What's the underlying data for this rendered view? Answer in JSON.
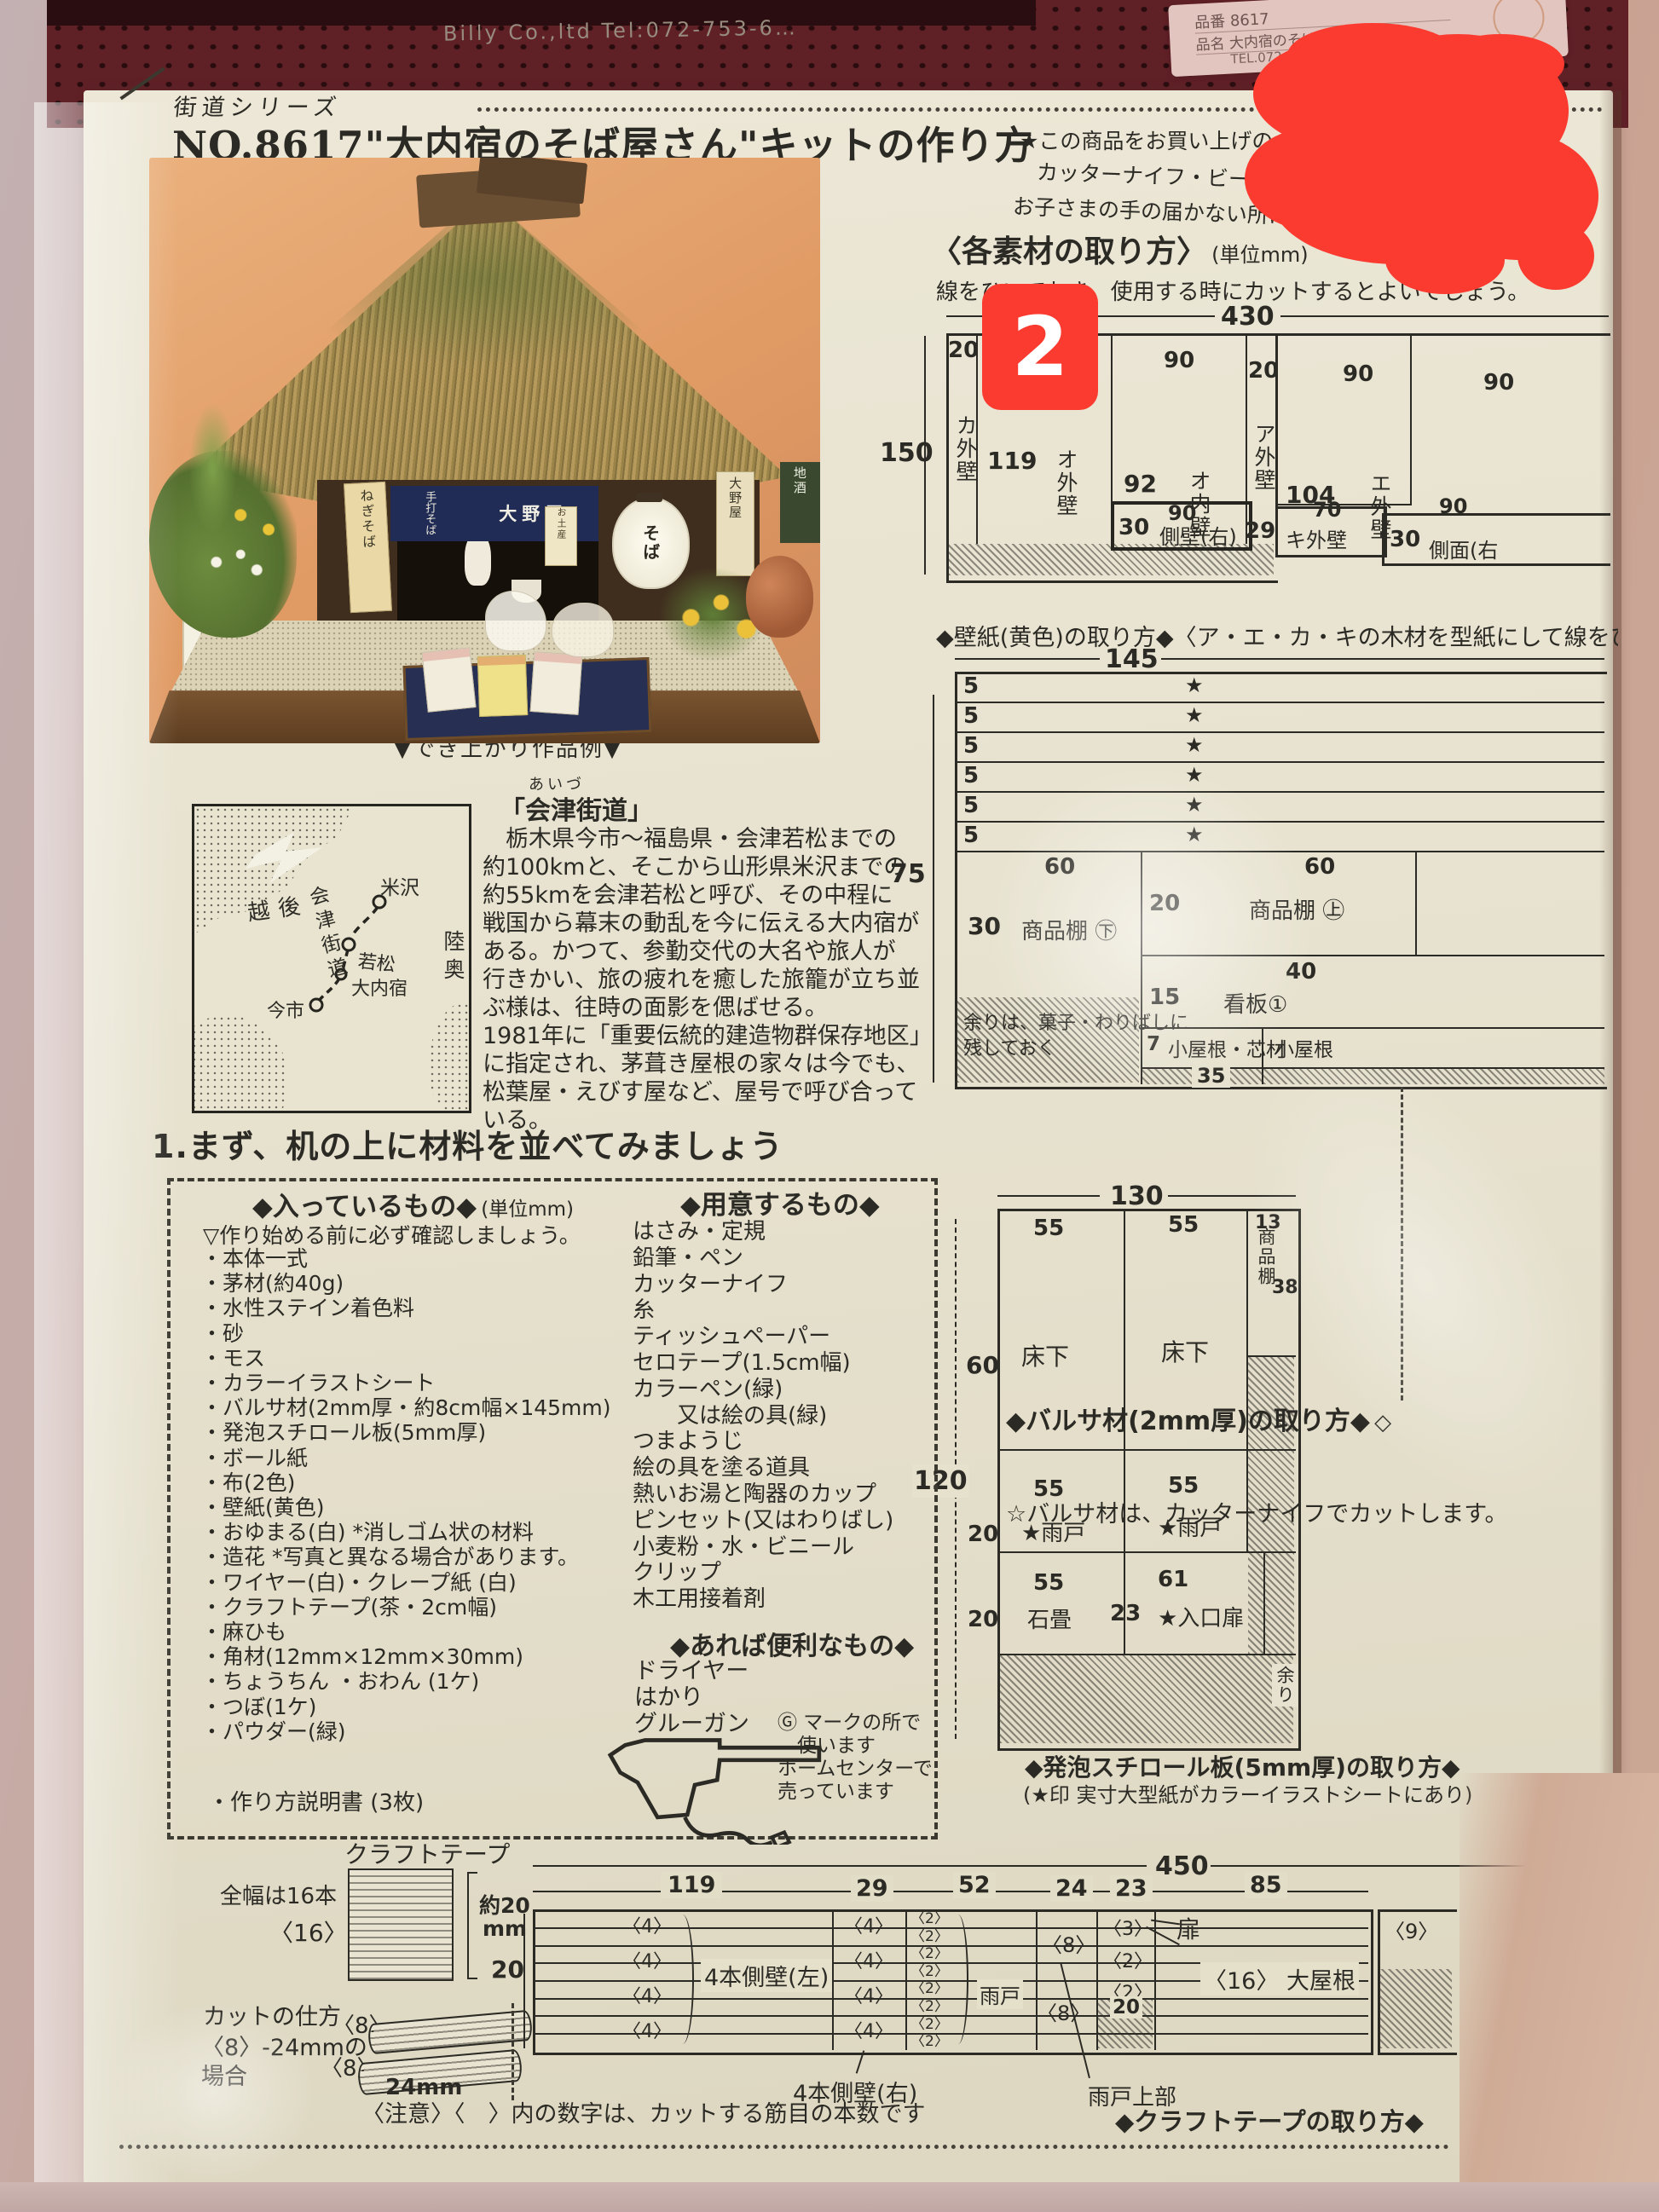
{
  "annotation": {
    "badge": "2"
  },
  "bag": {
    "brand": "Billy Co.,ltd  Tel:072-753-6…",
    "label_product_no": "品番 8617",
    "label_product_name": "品名 大内宿のそば屋さん",
    "label_tel": "TEL.072-755-5420"
  },
  "header": {
    "series": "街道シリーズ",
    "title": "NO.8617\"大内宿のそば屋さん\"キットの作り方"
  },
  "warnings": {
    "line1": "★この商品をお買い上げの",
    "line2": "カッターナイフ・ビーズ・ボ",
    "line3": "お子さまの手の届かない所に保管して"
  },
  "materials_section": {
    "title": "〈各素材の取り方〉",
    "unit": "(単位mm)",
    "note": "線をひいておき、使用する時にカットするとよいでしょう。"
  },
  "wallpaper_diagram": {
    "caption": "◆壁紙(黄色)の取り方◆〈ア・エ・カ・キの木材を型紙にして線をひき、",
    "dim_total_w": "430",
    "dim_total_h": "150",
    "col_dims": [
      "20",
      "90",
      "90",
      "20",
      "90",
      "90"
    ],
    "cells": {
      "ka": "カ外壁",
      "o_out_h": "119",
      "o_out": "オ外壁",
      "o_in_h": "92",
      "o_in": "オ内壁",
      "sokuheki_h": "30",
      "sokuheki_w": "90",
      "sokuheki": "側壁(右)",
      "a": "ア外壁",
      "e_h": "104",
      "e": "エ外壁",
      "ki_h": "29",
      "ki_w": "70",
      "ki": "キ外壁",
      "sokumen_h": "30",
      "sokumen_w": "90",
      "sokumen": "側面(右"
    }
  },
  "balsa_diagram": {
    "caption": "◆バルサ材(2mm厚)の取り方◆",
    "g_mark": "◇",
    "note": "☆バルサ材は、カッターナイフでカットします。",
    "dim_total_w": "145",
    "dim_total_h": "75",
    "strip_dim": "5",
    "star": "★",
    "cells": {
      "left_h": "30",
      "left_w": "60",
      "left": "商品棚 ㊦",
      "r1_h": "20",
      "r1_w": "60",
      "r1": "商品棚 ㊤",
      "r2_h": "15",
      "r2_w": "40",
      "r2": "看板①",
      "r3_h": "7",
      "r3": "小屋根・芯材",
      "r3_dim": "35",
      "r4": "小屋根"
    },
    "leftover_line1": "余りは、菓子・わりばしに",
    "leftover_line2": "残しておく"
  },
  "styrofoam_diagram": {
    "caption": "◆発泡スチロール板(5mm厚)の取り方◆",
    "caption2": "(★印 実寸大型紙がカラーイラストシートにあり)",
    "dim_total_w": "130",
    "dim_total_h": "120",
    "row1_h": "60",
    "row2_h": "20",
    "row3_h": "20",
    "cells": {
      "c11_w": "55",
      "c11": "床下",
      "c12_w": "55",
      "c12": "床下",
      "c13_w": "13",
      "c13": "商品棚",
      "c13_h": "38",
      "c21_w": "55",
      "c21": "★雨戸",
      "c22_w": "55",
      "c22": "★雨戸",
      "c31_w": "55",
      "c31": "石畳",
      "c32_w": "61",
      "c32": "★入口扉",
      "c32_h": "23"
    },
    "leftover": "余り"
  },
  "photo": {
    "caption": "▼でき上がり作品例▼",
    "noren_text": "手打そば",
    "noren_shop": "大野屋",
    "lantern": "そば",
    "banner_left": "ねぎそば",
    "sign_left": "大内宿",
    "banner_right": "大野屋",
    "banner_far_right": "地酒",
    "sign_small": "お土産"
  },
  "map": {
    "labels": {
      "echigo": "越後",
      "yonezawa": "米沢",
      "kaido": "会津街道",
      "wakamatsu": "若松",
      "ouchijuku": "大内宿",
      "imaichi": "今市",
      "mutsu": "陸奥"
    }
  },
  "history": {
    "furigana": "あいづ",
    "title": "「会津街道」",
    "lines": [
      "　栃木県今市〜福島県・会津若松までの",
      "約100kmと、そこから山形県米沢までの",
      "約55kmを会津若松と呼び、その中程に",
      "戦国から幕末の動乱を今に伝える大内宿が",
      "ある。かつて、参勤交代の大名や旅人が",
      "行きかい、旅の疲れを癒した旅籠が立ち並",
      "ぶ様は、往時の面影を偲ばせる。",
      "1981年に「重要伝統的建造物群保存地区」",
      "に指定され、茅葺き屋根の家々は今でも、",
      "松葉屋・えびす屋など、屋号で呼び合って",
      "いる。"
    ]
  },
  "section1": {
    "title": "1.まず、机の上に材料を並べてみましょう",
    "included": {
      "header": "◆入っているもの◆",
      "unit": "(単位mm)",
      "note": "▽作り始める前に必ず確認しましょう。",
      "items": [
        "・本体一式",
        "・茅材(約40g)",
        "・水性ステイン着色料",
        "・砂",
        "・モス",
        "・カラーイラストシート",
        "・バルサ材(2mm厚・約8cm幅×145mm)",
        "・発泡スチロール板(5mm厚)",
        "・ボール紙",
        "・布(2色)",
        "・壁紙(黄色)",
        "・おゆまる(白) *消しゴム状の材料",
        "・造花 *写真と異なる場合があります。",
        "・ワイヤー(白)・クレープ紙 (白)",
        "・クラフトテープ(茶・2cm幅)",
        "・麻ひも",
        "・角材(12mm×12mm×30mm)",
        "・ちょうちん ・おわん (1ケ)",
        "・つぼ(1ケ)",
        "・パウダー(緑)"
      ],
      "last_item": "・作り方説明書 (3枚)"
    },
    "tools": {
      "header": "◆用意するもの◆",
      "items": [
        "はさみ・定規",
        "鉛筆・ペン",
        "カッターナイフ",
        "糸",
        "ティッシュペーパー",
        "セロテープ(1.5cm幅)",
        "カラーペン(緑)",
        "　　又は絵の具(緑)",
        "つまようじ",
        "絵の具を塗る道具",
        "熱いお湯と陶器のカップ",
        "ピンセット(又はわりばし)",
        "小麦粉・水・ビニール",
        "クリップ",
        "木工用接着剤"
      ]
    },
    "handy": {
      "header": "◆あれば便利なもの◆",
      "items": [
        "ドライヤー",
        "はかり",
        "グルーガン"
      ],
      "g_note": [
        "Ⓖ マークの所で",
        "　使います",
        "ホームセンターで",
        "売っています"
      ]
    }
  },
  "craft_tape": {
    "title": "クラフトテープ",
    "full_width": "全幅は16本",
    "count16": "〈16〉",
    "approx": "約20",
    "approx_unit": "mm",
    "height_dim": "20",
    "cut_how": "カットの仕方",
    "cut_case1": "〈8〉-24mmの",
    "cut_case2": "場合",
    "n8a": "〈8〉",
    "n8b": "〈8〉",
    "mm24": "24mm"
  },
  "bottom_diagram": {
    "caption": "◆クラフトテープの取り方◆",
    "notice": "〈注意〉〈　〉内の数字は、カットする筋目の本数です",
    "dim_total": "450",
    "seg_dims": [
      "119",
      "29",
      "52",
      "24",
      "23",
      "85"
    ],
    "c4": "〈4〉",
    "c2": "〈2〉",
    "c8": "〈8〉",
    "c3": "〈3〉",
    "c16_label": "〈16〉 大屋根",
    "c9": "〈9〉",
    "label_left_wall": "4本側壁(左)",
    "label_right_wall": "4本側壁(右)",
    "label_amado": "雨戸",
    "label_amado_top": "雨戸上部",
    "label_tobira": "扉",
    "hatch20": "20"
  }
}
